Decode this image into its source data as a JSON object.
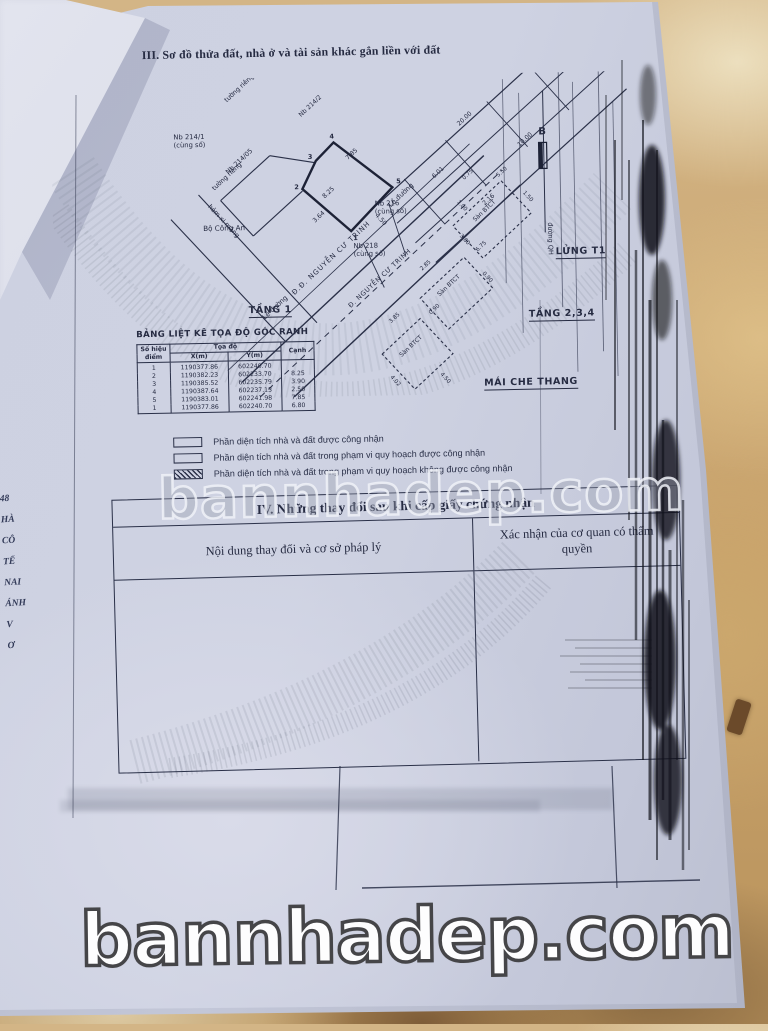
{
  "photo": {
    "watermark": "bannhadep.com",
    "banner": "bannhadep.com"
  },
  "document": {
    "section3_title": "III. Sơ đồ thửa đất, nhà ở và tài sản khác gắn liền với đất",
    "diagram": {
      "labels": {
        "tuong_rieng": "tường riêng",
        "nb_214_1": "Nb 214/1",
        "nb_214_2": "Nb 214/2",
        "nb_214_05": "Nb 214/05",
        "nb_216": "Nb 216",
        "nb_218": "Nb 218",
        "cung_so": "(cùng số)",
        "hem_xi_mang": "hẻm xi măng",
        "bo_cong_an": "Bộ Công An",
        "le_duong": "Lề đường",
        "street_dd": "Đ.Đ. NGUYỄN CƯ TRINH",
        "street_d": "Đ. NGUYỄN CƯ TRINH",
        "duong_qh": "đường QH",
        "san_btct": "Sàn BTCT",
        "compass": "B"
      },
      "measurements": [
        "7.85",
        "8.25",
        "3.64",
        "4.50",
        "20.00",
        "10.00",
        "6.01",
        "2.16",
        "0.75",
        "5.50",
        "1.50",
        "1.00",
        "3.80",
        "6.75",
        "2.85",
        "0.90",
        "4.02",
        "3.85",
        "4.50",
        "0.90"
      ],
      "vertices": [
        "1",
        "2",
        "3",
        "4",
        "5"
      ]
    },
    "floor_headings": {
      "tang1": "TẦNG 1",
      "lung": "LỬNG T1",
      "tang234": "TẦNG 2,3,4",
      "mai_che_thang": "MÁI CHE THANG"
    },
    "coord_table": {
      "title": "BẢNG LIỆT KÊ TỌA ĐỘ GÓC RANH",
      "headers": {
        "point": "Số hiệu điểm",
        "coords": "Tọa độ",
        "x": "X(m)",
        "y": "Y(m)",
        "edge": "Cạnh"
      },
      "rows": [
        {
          "point": "1",
          "x": "1190377.86",
          "y": "602240.70",
          "edge": ""
        },
        {
          "point": "2",
          "x": "1190382.23",
          "y": "602233.70",
          "edge": "8.25"
        },
        {
          "point": "3",
          "x": "1190385.52",
          "y": "602235.79",
          "edge": "3.90"
        },
        {
          "point": "4",
          "x": "1190387.64",
          "y": "602237.13",
          "edge": "2.50"
        },
        {
          "point": "5",
          "x": "1190383.01",
          "y": "602241.98",
          "edge": "7.85"
        },
        {
          "point": "1",
          "x": "1190377.86",
          "y": "602240.70",
          "edge": "6.80"
        }
      ]
    },
    "legend": {
      "items": [
        "Phần diện tích nhà và đất được công nhận",
        "Phần diện tích nhà và đất trong phạm vi quy hoạch được công nhận",
        "Phần diện tích nhà và đất trong phạm vi quy hoạch không được công nhận"
      ]
    },
    "section4": {
      "heading": "IV. Những thay đổi sau khi cấp giấy chứng nhận",
      "col1": "Nội dung thay đổi và cơ sở pháp lý",
      "col2": "Xác nhận của cơ quan có thẩm quyền"
    },
    "margin_fragments": [
      "48",
      "HÀ",
      "CÔ",
      "TẾ",
      "NAI",
      "ÁNH",
      "V",
      "Ơ"
    ]
  }
}
